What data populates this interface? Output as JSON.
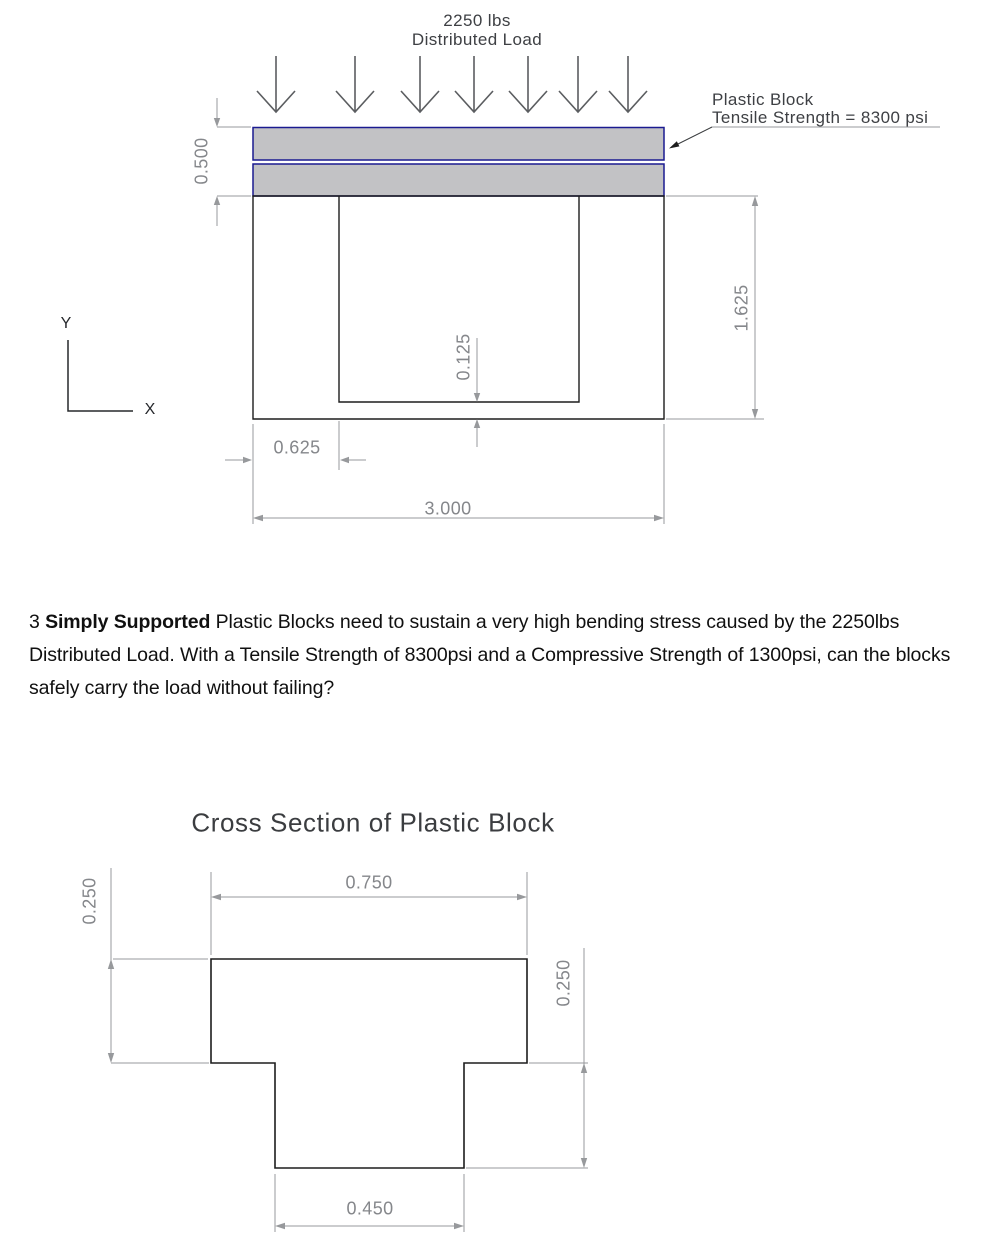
{
  "figure_side_view": {
    "load_label_line1": "2250 lbs",
    "load_label_line2": "Distributed Load",
    "block_label_line1": "Plastic Block",
    "block_label_line2": "Tensile Strength = 8300 psi",
    "dims": {
      "block_stack_height": "0.500",
      "support_height": "1.625",
      "floor_thickness": "0.125",
      "wall_width": "0.625",
      "total_width": "3.000"
    },
    "axis": {
      "x_label": "X",
      "y_label": "Y"
    },
    "colors": {
      "block_fill": "#c2c2c5",
      "block_outline": "#1a1a90",
      "shape_line": "#1d1d1d",
      "dimension": "#97999c"
    }
  },
  "problem_text": {
    "prefix": "3 ",
    "bold": "Simply Supported",
    "body": " Plastic Blocks need to sustain a very high bending stress caused by the 2250lbs Distributed Load. With a Tensile Strength of 8300psi and a Compressive Strength of 1300psi, can the blocks safely carry the load without failing?"
  },
  "figure_cross_section": {
    "title": "Cross Section of Plastic Block",
    "dims": {
      "flange_width": "0.750",
      "flange_thickness": "0.250",
      "stem_height": "0.250",
      "stem_width": "0.450"
    }
  }
}
